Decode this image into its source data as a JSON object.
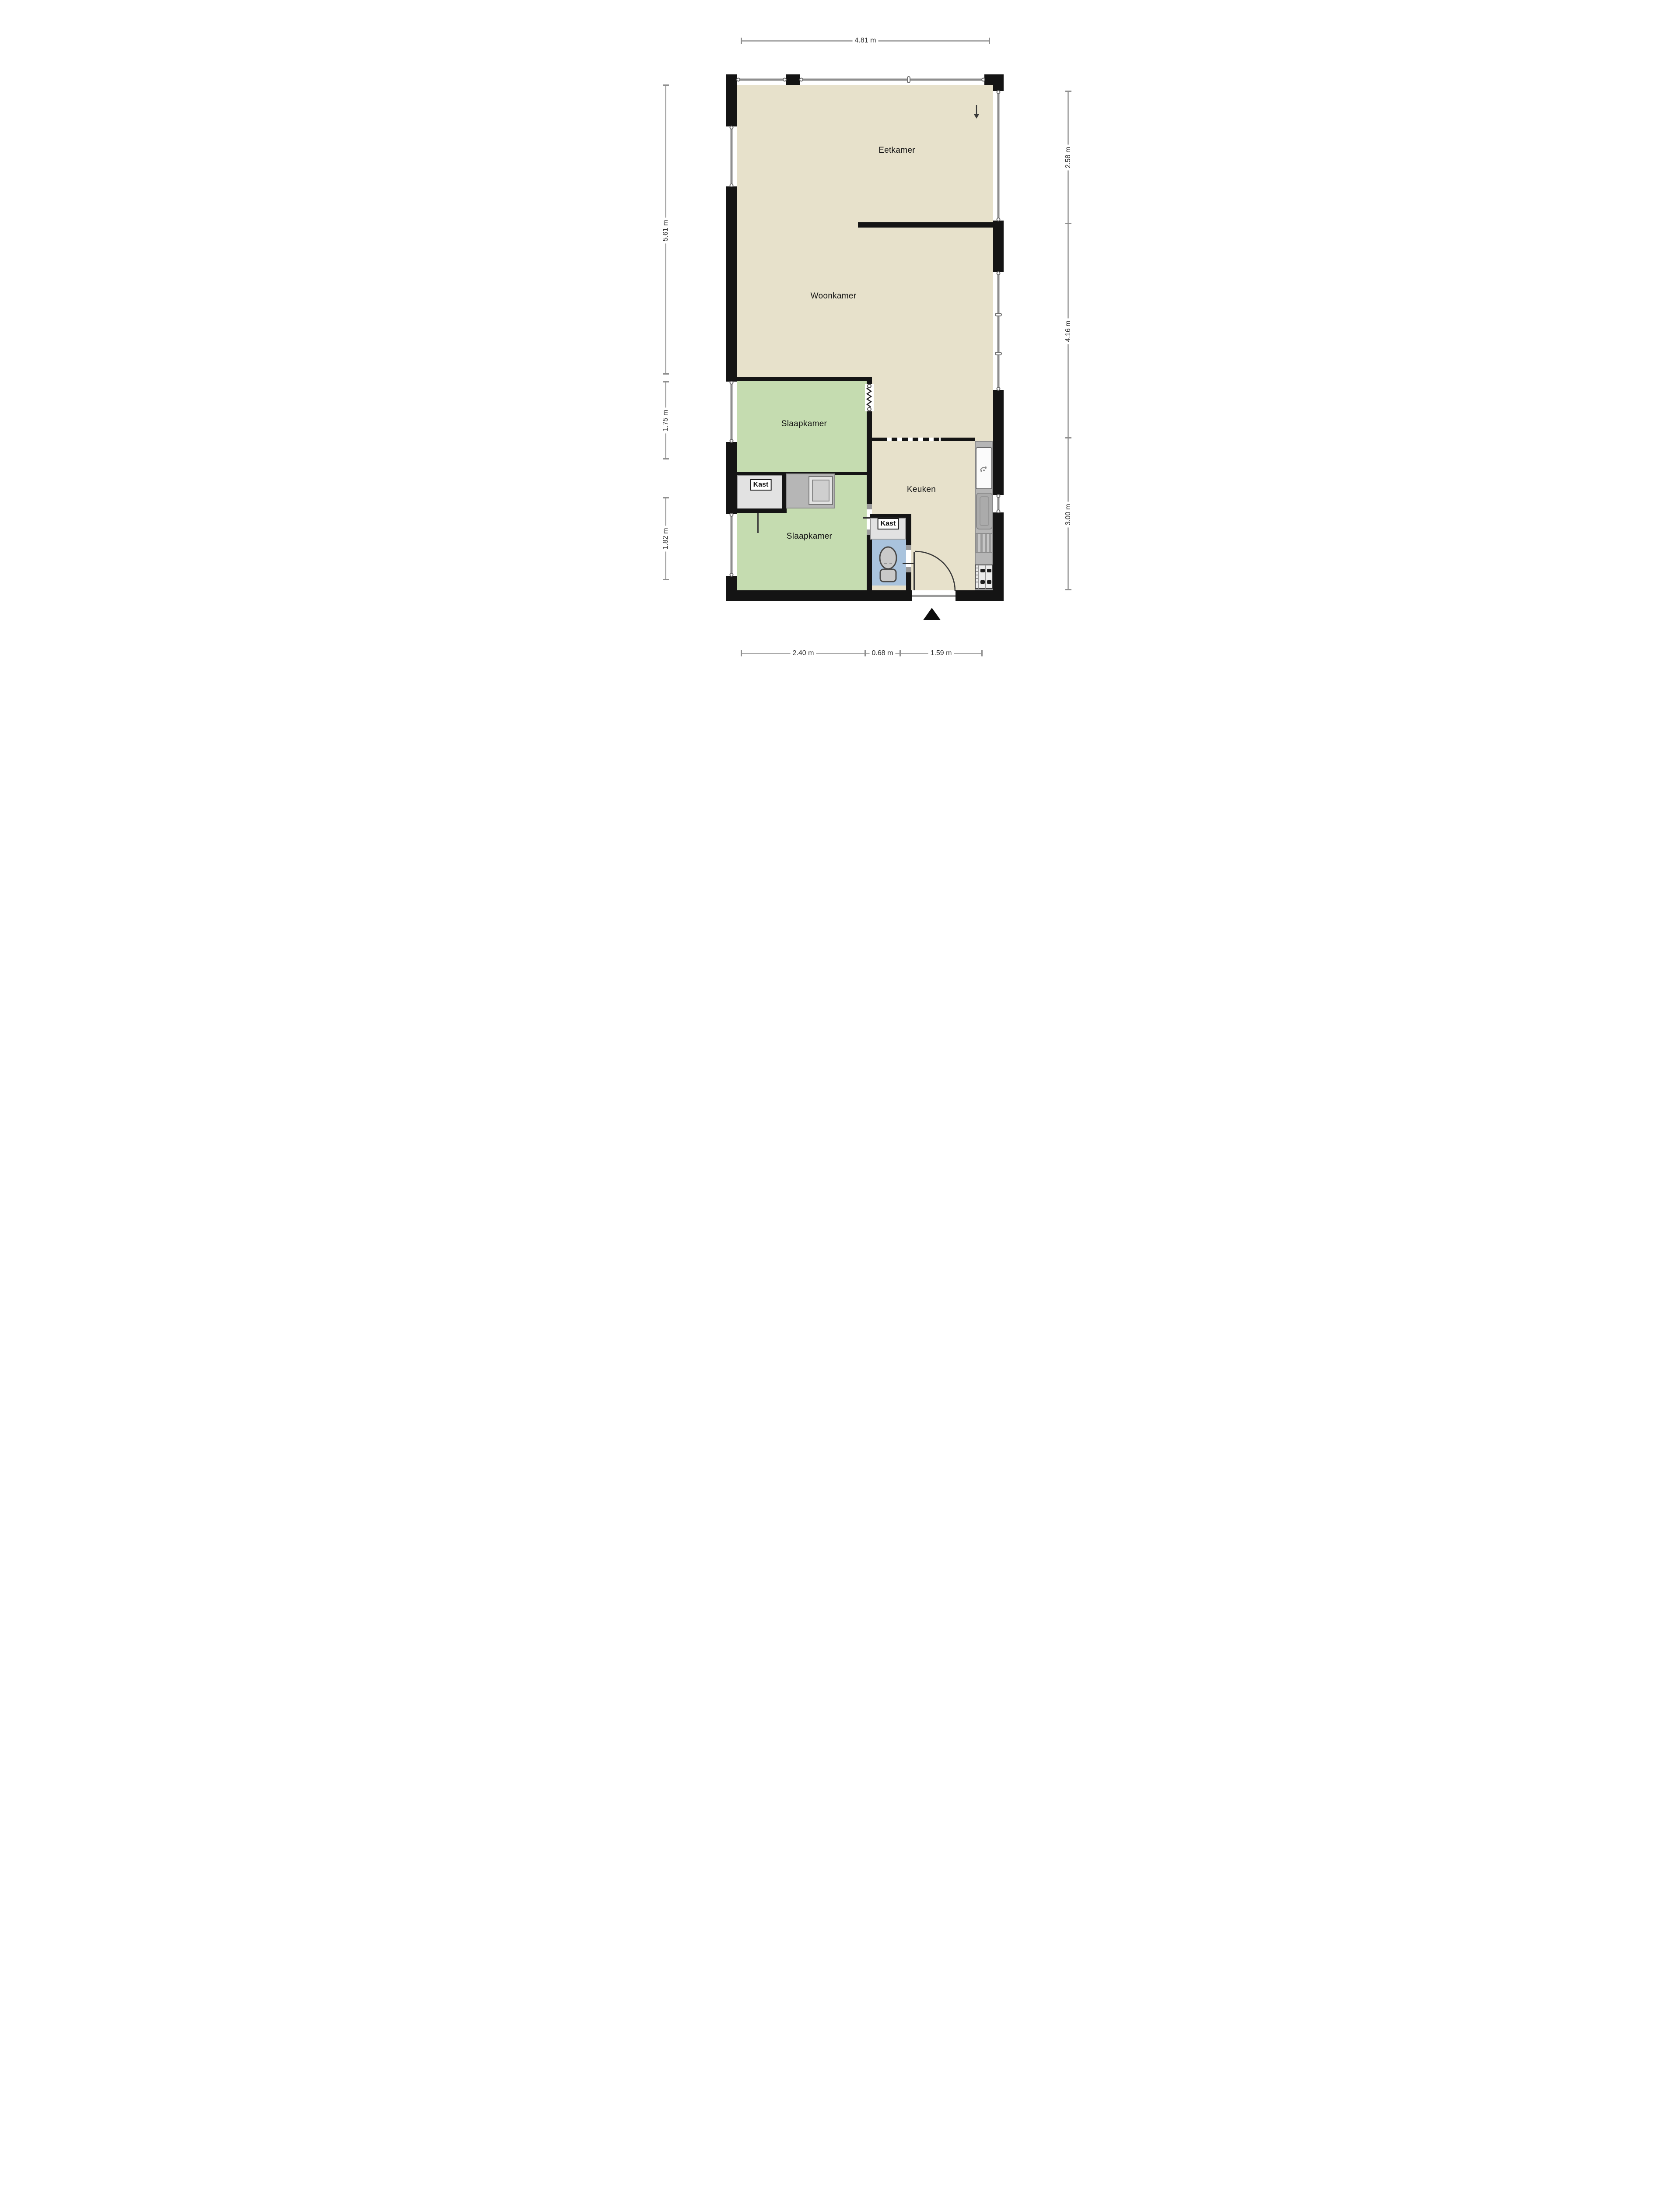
{
  "labels": {
    "eetkamer": "Eetkamer",
    "woonkamer": "Woonkamer",
    "slaapkamer_boven": "Slaapkamer",
    "slaapkamer_onder": "Slaapkamer",
    "keuken": "Keuken",
    "kast_boven": "Kast",
    "kast_onder": "Kast"
  },
  "dims": {
    "top": [
      "4.81 m"
    ],
    "left": [
      "5.61 m",
      "1.75 m",
      "1.82 m"
    ],
    "right": [
      "2.58 m",
      "4.16 m",
      "3.00 m"
    ],
    "bottom": [
      "2.40 m",
      "0.68 m",
      "1.59 m"
    ]
  },
  "icons": {
    "entrance_marker": "triangle-up",
    "flow_arrow": "arrow-down",
    "fixtures": [
      "toilet",
      "washbasin",
      "kitchen-sink-tap",
      "sink-basin",
      "drainer",
      "stove-4-burner",
      "accordion-door",
      "door-swing"
    ]
  },
  "colors": {
    "wall": "#141414",
    "floor": "#e7e1cb",
    "bedroom": "#c5dcb0",
    "toilet": "#a9c3dd",
    "counter": "#b6b6b6",
    "closet": "#e2e2e2",
    "glass": "#8f8f8f",
    "dim_line": "#ababab",
    "dim_text": "#2a2a2a"
  }
}
